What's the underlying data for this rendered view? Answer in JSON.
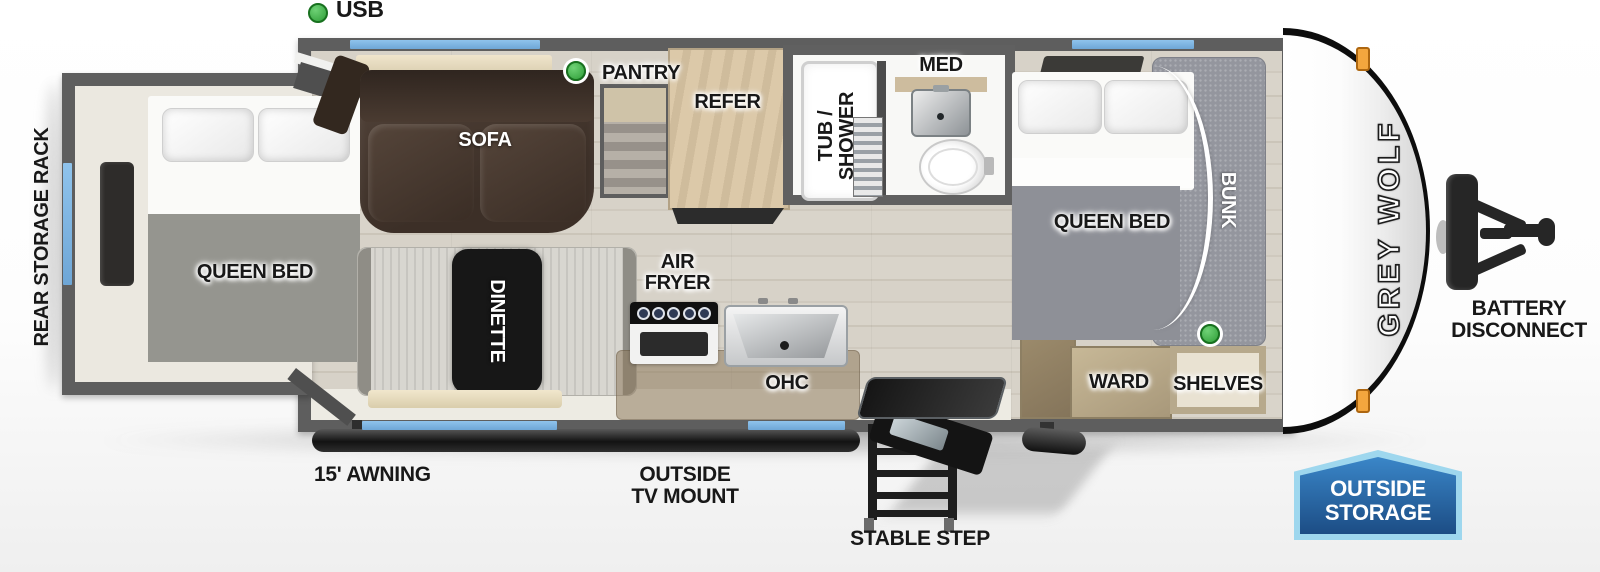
{
  "legend": {
    "usb": "USB"
  },
  "floorplan": {
    "rear_storage_rack": "REAR STORAGE RACK",
    "rear_bedroom": {
      "queen_bed": "QUEEN BED"
    },
    "living": {
      "sofa": "SOFA",
      "dinette": "DINETTE",
      "pantry": "PANTRY",
      "refer": "REFER"
    },
    "kitchen": {
      "air_fryer_line1": "AIR",
      "air_fryer_line2": "FRYER",
      "ohc": "OHC"
    },
    "bath": {
      "tub_shower_line1": "TUB /",
      "tub_shower_line2": "SHOWER",
      "med": "MED"
    },
    "front_bedroom": {
      "queen_bed": "QUEEN BED",
      "bunk": "BUNK",
      "ward": "WARD",
      "shelves": "SHELVES"
    }
  },
  "exterior": {
    "awning": "15' AWNING",
    "tv_mount_line1": "OUTSIDE",
    "tv_mount_line2": "TV MOUNT",
    "stable_step": "STABLE STEP",
    "battery_line1": "BATTERY",
    "battery_line2": "DISCONNECT",
    "outside_storage_line1": "OUTSIDE",
    "outside_storage_line2": "STORAGE",
    "brand": "GREY WOLF"
  },
  "colors": {
    "wall_gray": "#5e5e5e",
    "window_blue": "#7db9e8",
    "usb_green": "#3aa843",
    "marker_orange": "#f0a43c",
    "badge_fill": "#2e79c0",
    "badge_border": "#9ed7ee"
  }
}
